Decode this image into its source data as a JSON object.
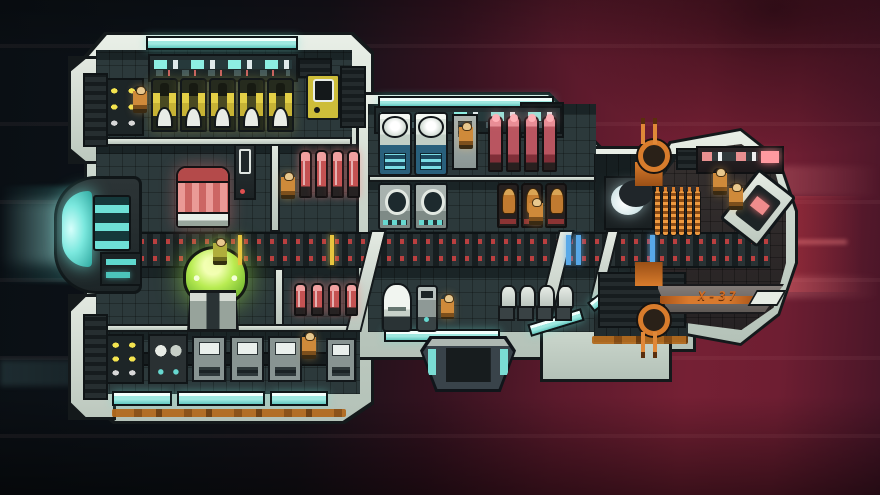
{
  "meta": {
    "ship_label": "X-37",
    "crew_visible": 12
  },
  "palette": {
    "hull_light": "#cdd8ce",
    "outline": "#14191b",
    "floor": "#2c393b",
    "engine_glow": "#7be8de",
    "window_cyan": "#9fe8e0",
    "pod_yellow": "#e3cf46",
    "canister_red": "#c45252",
    "dome_green": "#b8ec52",
    "reactor_pink": "#ea9a96",
    "crew_orange": "#cf8a3a",
    "mast_orange": "#d87c2c",
    "rust_stripe": "#b26a1e",
    "corridor_dash_red": "#c24040",
    "space_left": "#0d1218",
    "space_right": "#5c1a2c"
  },
  "objects": [
    {
      "n": "engine-glow-trail",
      "t": "glow-beam",
      "x": 0,
      "y": 186,
      "w": 120,
      "h": 96,
      "i": false
    },
    {
      "n": "engine-glow-core",
      "t": "glow-wide",
      "x": 0,
      "y": 200,
      "w": 80,
      "h": 64,
      "i": false
    },
    {
      "n": "red-glow-rays",
      "t": "glow-red",
      "x": 762,
      "y": 196,
      "w": 118,
      "h": 96,
      "i": false
    },
    {
      "n": "streak-red-upper",
      "t": "streak",
      "x": 486,
      "y": 166,
      "w": 394,
      "h": 30,
      "i": false
    },
    {
      "n": "streak-red-lower",
      "t": "streak",
      "x": 560,
      "y": 276,
      "w": 320,
      "h": 22,
      "i": false
    },
    {
      "n": "streak-teal-left",
      "t": "streak-teal",
      "x": 0,
      "y": 360,
      "w": 240,
      "h": 26,
      "i": false
    },
    {
      "n": "hull-left-block",
      "t": "hull-a hull",
      "x": 84,
      "y": 32,
      "w": 290,
      "h": 392,
      "i": false
    },
    {
      "n": "hull-pod-topleft",
      "t": "pod",
      "x": 68,
      "y": 56,
      "w": 48,
      "h": 108,
      "i": false
    },
    {
      "n": "hull-pod-bottomleft",
      "t": "pod",
      "x": 68,
      "y": 294,
      "w": 48,
      "h": 126,
      "i": false
    },
    {
      "n": "hull-mid-block",
      "t": "hull-b hull",
      "x": 356,
      "y": 92,
      "w": 258,
      "h": 268,
      "i": false
    },
    {
      "n": "hull-neck",
      "t": "hull-c hull",
      "x": 584,
      "y": 146,
      "w": 112,
      "h": 206,
      "i": false
    },
    {
      "n": "hull-lower-wedge",
      "t": "hull-d hull",
      "x": 540,
      "y": 296,
      "w": 132,
      "h": 86,
      "i": false
    },
    {
      "n": "hull-cockpit",
      "t": "hull-e hull",
      "x": 648,
      "y": 128,
      "w": 150,
      "h": 218,
      "i": false
    },
    {
      "n": "room-engineering-floor",
      "t": "floor",
      "x": 96,
      "y": 50,
      "w": 256,
      "h": 94,
      "i": false
    },
    {
      "n": "room-left-mid-floor",
      "t": "floor",
      "x": 96,
      "y": 144,
      "w": 260,
      "h": 88,
      "i": false
    },
    {
      "n": "room-left-lower-floor",
      "t": "floor",
      "x": 96,
      "y": 268,
      "w": 260,
      "h": 62,
      "i": false
    },
    {
      "n": "room-workshop-floor",
      "t": "floor",
      "x": 96,
      "y": 330,
      "w": 264,
      "h": 64,
      "i": false
    },
    {
      "n": "room-mid-top-floor",
      "t": "floor",
      "x": 368,
      "y": 104,
      "w": 228,
      "h": 76,
      "i": false
    },
    {
      "n": "room-mid-seats-floor",
      "t": "floor",
      "x": 368,
      "y": 180,
      "w": 228,
      "h": 52,
      "i": false
    },
    {
      "n": "room-mid-lower-floor",
      "t": "floor",
      "x": 368,
      "y": 268,
      "w": 228,
      "h": 64,
      "i": false
    },
    {
      "n": "neck-interior",
      "t": "floor-dark",
      "x": 594,
      "y": 154,
      "w": 94,
      "h": 188,
      "i": false
    },
    {
      "n": "cockpit-interior",
      "t": "cockpit-floor",
      "x": 662,
      "y": 144,
      "w": 124,
      "h": 186,
      "i": false
    },
    {
      "n": "main-corridor",
      "t": "corridor",
      "x": 88,
      "y": 232,
      "w": 682,
      "h": 36,
      "i": false
    },
    {
      "n": "deck-divider-left",
      "t": "bar",
      "x": 96,
      "y": 137,
      "w": 256,
      "h": 9,
      "i": false
    },
    {
      "n": "wall-left-mid",
      "t": "bar-v",
      "x": 270,
      "y": 144,
      "w": 10,
      "h": 88,
      "i": false
    },
    {
      "n": "wall-left-lower",
      "t": "bar-v",
      "x": 274,
      "y": 268,
      "w": 10,
      "h": 60,
      "i": false
    },
    {
      "n": "deck-divider-workshop",
      "t": "bar",
      "x": 96,
      "y": 324,
      "w": 260,
      "h": 8,
      "i": false
    },
    {
      "n": "deck-divider-mid",
      "t": "bar",
      "x": 368,
      "y": 175,
      "w": 228,
      "h": 7,
      "i": false
    },
    {
      "n": "rib-left",
      "t": "rib",
      "x": 358,
      "y": 230,
      "w": 16,
      "h": 102,
      "i": false
    },
    {
      "n": "rib-right",
      "t": "rib",
      "x": 546,
      "y": 230,
      "w": 16,
      "h": 102,
      "i": false
    },
    {
      "n": "rib-neck",
      "t": "rib",
      "x": 598,
      "y": 230,
      "w": 13,
      "h": 70,
      "i": false
    },
    {
      "n": "skylight-left",
      "t": "win",
      "x": 146,
      "y": 36,
      "w": 152,
      "h": 14,
      "i": false
    },
    {
      "n": "skylight-mid",
      "t": "win",
      "x": 378,
      "y": 96,
      "w": 176,
      "h": 12,
      "i": false
    },
    {
      "n": "window-bottom-1",
      "t": "win",
      "x": 112,
      "y": 391,
      "w": 60,
      "h": 15,
      "i": false
    },
    {
      "n": "window-bottom-2",
      "t": "win",
      "x": 177,
      "y": 391,
      "w": 88,
      "h": 15,
      "i": false
    },
    {
      "n": "window-bottom-3",
      "t": "win",
      "x": 270,
      "y": 391,
      "w": 58,
      "h": 15,
      "i": false
    },
    {
      "n": "window-mid-1",
      "t": "win",
      "x": 384,
      "y": 329,
      "w": 116,
      "h": 13,
      "i": false
    },
    {
      "n": "window-mid-2",
      "t": "win",
      "x": 528,
      "y": 316,
      "w": 56,
      "h": 13,
      "i": false,
      "css": "transform:rotate(-17deg)"
    },
    {
      "n": "window-wedge",
      "t": "win",
      "x": 586,
      "y": 288,
      "w": 44,
      "h": 12,
      "i": false,
      "css": "transform:rotate(-38deg)"
    },
    {
      "n": "rust-stripe-left",
      "t": "rust",
      "x": 112,
      "y": 409,
      "w": 234,
      "h": 8,
      "i": false
    },
    {
      "n": "rust-stripe-neck",
      "t": "rust",
      "x": 592,
      "y": 336,
      "w": 96,
      "h": 8,
      "i": false
    },
    {
      "n": "vent-left-top",
      "t": "vent",
      "x": 298,
      "y": 58,
      "w": 34,
      "h": 20,
      "i": false
    },
    {
      "n": "vent-left-right",
      "t": "vent",
      "x": 340,
      "y": 66,
      "w": 26,
      "h": 62,
      "i": false
    },
    {
      "n": "vent-mid-top",
      "t": "vent",
      "x": 520,
      "y": 102,
      "w": 44,
      "h": 36,
      "i": false
    },
    {
      "n": "vent-cockpit-top",
      "t": "vent",
      "x": 676,
      "y": 148,
      "w": 52,
      "h": 22,
      "i": false
    },
    {
      "n": "vent-neck-lower",
      "t": "vent",
      "x": 598,
      "y": 272,
      "w": 88,
      "h": 56,
      "i": false
    },
    {
      "n": "cockpit-hull-band",
      "t": "band",
      "x": 656,
      "y": 284,
      "w": 128,
      "h": 30,
      "i": false
    },
    {
      "n": "ship-name-stripe",
      "t": "lstripe",
      "x": 660,
      "y": 296,
      "w": 96,
      "h": 8,
      "i": false
    },
    {
      "n": "ship-name-wedge",
      "t": "wedge",
      "x": 752,
      "y": 290,
      "w": 30,
      "h": 16,
      "i": false
    },
    {
      "n": "engine-housing",
      "t": "engine",
      "x": 54,
      "y": 176,
      "w": 88,
      "h": 118,
      "i": true
    },
    {
      "n": "engine-control-panel",
      "t": "epanel",
      "x": 100,
      "y": 252,
      "w": 42,
      "h": 34,
      "i": true
    },
    {
      "n": "console-wall-left",
      "t": "pwall",
      "x": 148,
      "y": 54,
      "w": 150,
      "h": 28,
      "i": true
    },
    {
      "n": "console-wall-mid",
      "t": "pwall",
      "x": 374,
      "y": 106,
      "w": 188,
      "h": 28,
      "i": true
    },
    {
      "n": "battery-rack",
      "t": "lrack",
      "x": 102,
      "y": 78,
      "w": 42,
      "h": 58,
      "i": true
    },
    {
      "n": "yellow-pod-1",
      "t": "ypod",
      "x": 151,
      "y": 78,
      "w": 27,
      "h": 54,
      "i": true
    },
    {
      "n": "yellow-pod-2",
      "t": "ypod",
      "x": 180,
      "y": 78,
      "w": 27,
      "h": 54,
      "i": true
    },
    {
      "n": "yellow-pod-3",
      "t": "ypod",
      "x": 209,
      "y": 78,
      "w": 27,
      "h": 54,
      "i": true
    },
    {
      "n": "yellow-pod-4",
      "t": "ypod",
      "x": 238,
      "y": 78,
      "w": 27,
      "h": 54,
      "i": true
    },
    {
      "n": "yellow-pod-5",
      "t": "ypod",
      "x": 267,
      "y": 78,
      "w": 27,
      "h": 54,
      "i": true
    },
    {
      "n": "wall-terminal",
      "t": "term",
      "x": 306,
      "y": 74,
      "w": 34,
      "h": 46,
      "i": true
    },
    {
      "n": "reactor-red-cylinder",
      "t": "redcyl",
      "x": 176,
      "y": 166,
      "w": 54,
      "h": 62,
      "i": true
    },
    {
      "n": "locker-dark",
      "t": "locker",
      "x": 234,
      "y": 144,
      "w": 22,
      "h": 56,
      "i": true
    },
    {
      "n": "canister-red-1",
      "t": "can",
      "x": 299,
      "y": 150,
      "w": 13,
      "h": 48,
      "i": true
    },
    {
      "n": "canister-red-2",
      "t": "can",
      "x": 315,
      "y": 150,
      "w": 13,
      "h": 48,
      "i": true
    },
    {
      "n": "canister-red-3",
      "t": "can",
      "x": 331,
      "y": 150,
      "w": 13,
      "h": 48,
      "i": true
    },
    {
      "n": "canister-red-4",
      "t": "can",
      "x": 347,
      "y": 150,
      "w": 13,
      "h": 48,
      "i": true
    },
    {
      "n": "shield-generator-dome",
      "t": "dome",
      "x": 182,
      "y": 246,
      "w": 62,
      "h": 86,
      "i": true
    },
    {
      "n": "canister-red-5",
      "t": "can2",
      "x": 294,
      "y": 283,
      "w": 13,
      "h": 33,
      "i": true
    },
    {
      "n": "canister-red-6",
      "t": "can2",
      "x": 311,
      "y": 283,
      "w": 13,
      "h": 33,
      "i": true
    },
    {
      "n": "canister-red-7",
      "t": "can2",
      "x": 328,
      "y": 283,
      "w": 13,
      "h": 33,
      "i": true
    },
    {
      "n": "canister-red-8",
      "t": "can2",
      "x": 345,
      "y": 283,
      "w": 13,
      "h": 33,
      "i": true
    },
    {
      "n": "workshop-bench",
      "t": "bench",
      "x": 100,
      "y": 352,
      "w": 252,
      "h": 14,
      "i": false
    },
    {
      "n": "workshop-light-unit",
      "t": "lrack",
      "x": 104,
      "y": 334,
      "w": 40,
      "h": 50,
      "i": true
    },
    {
      "n": "workshop-pod-unit",
      "t": "wunit",
      "x": 148,
      "y": 334,
      "w": 40,
      "h": 50,
      "i": true
    },
    {
      "n": "workshop-screen-unit-1",
      "t": "sunit",
      "x": 192,
      "y": 336,
      "w": 34,
      "h": 46,
      "i": true
    },
    {
      "n": "workshop-screen-unit-2",
      "t": "sunit",
      "x": 230,
      "y": 336,
      "w": 34,
      "h": 46,
      "i": true
    },
    {
      "n": "workshop-screen-unit-3",
      "t": "sunit",
      "x": 268,
      "y": 336,
      "w": 34,
      "h": 46,
      "i": true
    },
    {
      "n": "workshop-screen-unit-4",
      "t": "sunit",
      "x": 326,
      "y": 338,
      "w": 30,
      "h": 44,
      "i": true
    },
    {
      "n": "life-support-cylinder-1",
      "t": "wcyl",
      "x": 378,
      "y": 112,
      "w": 34,
      "h": 64,
      "i": true
    },
    {
      "n": "life-support-cylinder-2",
      "t": "wcyl",
      "x": 414,
      "y": 112,
      "w": 34,
      "h": 64,
      "i": true
    },
    {
      "n": "locker-grey",
      "t": "glocker",
      "x": 452,
      "y": 114,
      "w": 26,
      "h": 56,
      "i": true
    },
    {
      "n": "canister-pink-1",
      "t": "can3",
      "x": 488,
      "y": 116,
      "w": 15,
      "h": 56,
      "i": true
    },
    {
      "n": "canister-pink-2",
      "t": "can3",
      "x": 506,
      "y": 116,
      "w": 15,
      "h": 56,
      "i": true
    },
    {
      "n": "canister-pink-3",
      "t": "can3",
      "x": 524,
      "y": 116,
      "w": 15,
      "h": 56,
      "i": true
    },
    {
      "n": "canister-pink-4",
      "t": "can3",
      "x": 542,
      "y": 116,
      "w": 15,
      "h": 56,
      "i": true
    },
    {
      "n": "porthole-machine-1",
      "t": "pmach",
      "x": 378,
      "y": 183,
      "w": 34,
      "h": 47,
      "i": true
    },
    {
      "n": "porthole-machine-2",
      "t": "pmach",
      "x": 414,
      "y": 183,
      "w": 34,
      "h": 47,
      "i": true
    },
    {
      "n": "crew-seat-occupied-1",
      "t": "seatc",
      "x": 497,
      "y": 183,
      "w": 22,
      "h": 45,
      "i": true
    },
    {
      "n": "crew-seat-occupied-2",
      "t": "seatc",
      "x": 521,
      "y": 183,
      "w": 22,
      "h": 45,
      "i": true
    },
    {
      "n": "crew-seat-occupied-3",
      "t": "seatc",
      "x": 545,
      "y": 183,
      "w": 22,
      "h": 45,
      "i": true
    },
    {
      "n": "dome-machine-small",
      "t": "wdome",
      "x": 382,
      "y": 283,
      "w": 30,
      "h": 49,
      "i": true
    },
    {
      "n": "service-robot",
      "t": "robot",
      "x": 416,
      "y": 285,
      "w": 22,
      "h": 47,
      "i": true
    },
    {
      "n": "empty-seat-1",
      "t": "eseat",
      "x": 498,
      "y": 285,
      "w": 17,
      "h": 36,
      "i": true
    },
    {
      "n": "empty-seat-2",
      "t": "eseat",
      "x": 517,
      "y": 285,
      "w": 17,
      "h": 36,
      "i": true
    },
    {
      "n": "empty-seat-3",
      "t": "eseat",
      "x": 536,
      "y": 285,
      "w": 17,
      "h": 36,
      "i": true
    },
    {
      "n": "empty-seat-4",
      "t": "eseat",
      "x": 555,
      "y": 285,
      "w": 17,
      "h": 36,
      "i": true
    },
    {
      "n": "airlock-hatch",
      "t": "hatch",
      "x": 420,
      "y": 336,
      "w": 96,
      "h": 56,
      "i": true
    },
    {
      "n": "scanner-crescent",
      "t": "cres",
      "x": 604,
      "y": 176,
      "w": 50,
      "h": 54,
      "i": true
    },
    {
      "n": "coil-stack-1",
      "t": "coil",
      "x": 654,
      "y": 190,
      "w": 7,
      "h": 46,
      "i": true
    },
    {
      "n": "coil-stack-2",
      "t": "coil",
      "x": 662,
      "y": 190,
      "w": 7,
      "h": 46,
      "i": true
    },
    {
      "n": "coil-stack-3",
      "t": "coil",
      "x": 670,
      "y": 190,
      "w": 7,
      "h": 46,
      "i": true
    },
    {
      "n": "coil-stack-4",
      "t": "coil",
      "x": 678,
      "y": 190,
      "w": 7,
      "h": 46,
      "i": true
    },
    {
      "n": "coil-stack-5",
      "t": "coil",
      "x": 686,
      "y": 190,
      "w": 7,
      "h": 46,
      "i": true
    },
    {
      "n": "coil-stack-6",
      "t": "coil",
      "x": 694,
      "y": 190,
      "w": 7,
      "h": 46,
      "i": true
    },
    {
      "n": "pilot-console-wall",
      "t": "pwall2",
      "x": 696,
      "y": 146,
      "w": 88,
      "h": 28,
      "i": true
    },
    {
      "n": "nav-console-angled",
      "t": "acons",
      "x": 734,
      "y": 176,
      "w": 48,
      "h": 64,
      "i": true
    },
    {
      "n": "corridor-tick-yellow-1",
      "t": "tick-y",
      "x": 238,
      "y": 235,
      "w": 4,
      "h": 30,
      "i": false
    },
    {
      "n": "corridor-tick-yellow-2",
      "t": "tick-y",
      "x": 330,
      "y": 235,
      "w": 4,
      "h": 30,
      "i": false
    },
    {
      "n": "corridor-tick-blue-1",
      "t": "tick-b",
      "x": 566,
      "y": 235,
      "w": 5,
      "h": 30,
      "i": false
    },
    {
      "n": "corridor-tick-blue-2",
      "t": "tick-b",
      "x": 576,
      "y": 235,
      "w": 5,
      "h": 30,
      "i": false
    },
    {
      "n": "corridor-tick-blue-3",
      "t": "tick-b",
      "x": 650,
      "y": 235,
      "w": 5,
      "h": 30,
      "i": false
    },
    {
      "n": "antenna-mast-top",
      "t": "mast",
      "x": 626,
      "y": 118,
      "w": 46,
      "h": 68,
      "i": true
    },
    {
      "n": "antenna-mast-bottom",
      "t": "mast-b",
      "x": 626,
      "y": 262,
      "w": 46,
      "h": 96,
      "i": true
    },
    {
      "n": "crew-engineer",
      "t": "crew",
      "x": 133,
      "y": 86,
      "w": 14,
      "h": 27,
      "i": true
    },
    {
      "n": "crew-canister-deck",
      "t": "crew",
      "x": 281,
      "y": 172,
      "w": 14,
      "h": 27,
      "i": true
    },
    {
      "n": "crew-dome-room",
      "t": "crewy",
      "x": 213,
      "y": 238,
      "w": 14,
      "h": 27,
      "i": true
    },
    {
      "n": "crew-workshop",
      "t": "crew",
      "x": 302,
      "y": 332,
      "w": 14,
      "h": 27,
      "i": true
    },
    {
      "n": "crew-mid-top",
      "t": "crew",
      "x": 459,
      "y": 122,
      "w": 14,
      "h": 27,
      "i": true
    },
    {
      "n": "crew-mid-standing",
      "t": "crew",
      "x": 529,
      "y": 198,
      "w": 14,
      "h": 27,
      "i": true
    },
    {
      "n": "crew-mid-lower",
      "t": "crew",
      "x": 441,
      "y": 294,
      "w": 13,
      "h": 25,
      "i": true
    },
    {
      "n": "pilot-1",
      "t": "crew",
      "x": 713,
      "y": 168,
      "w": 14,
      "h": 27,
      "i": true
    },
    {
      "n": "pilot-2",
      "t": "crew",
      "x": 729,
      "y": 183,
      "w": 14,
      "h": 27,
      "i": true
    }
  ]
}
